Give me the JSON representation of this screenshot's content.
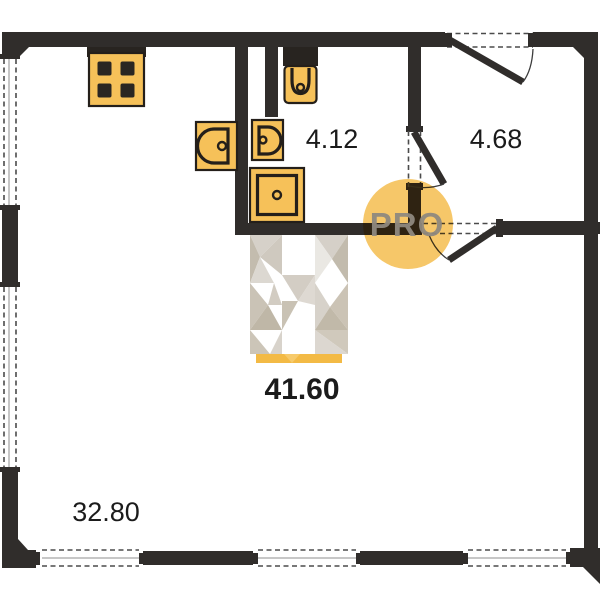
{
  "plan": {
    "title": "apartment-floor-plan",
    "labels": {
      "bathroom": "4.12",
      "hallway": "4.68",
      "total": "41.60",
      "living_room": "32.80"
    },
    "watermark": "PRO",
    "colors": {
      "wall": "#302d2b",
      "fixture": "#f6c159",
      "fixture_outline": "#241f1a",
      "watermark_circle": "#f5c25c",
      "watermark_text": "#8f897f",
      "label_text": "#1b1b1b",
      "wardrobe_base": "#f3ba45"
    },
    "fixtures": [
      "stove",
      "kitchen-sink",
      "washbasin",
      "toilet",
      "shower",
      "wardrobe"
    ],
    "openings": [
      "entrance-door",
      "bathroom-door",
      "hallway-door",
      "windows"
    ]
  }
}
